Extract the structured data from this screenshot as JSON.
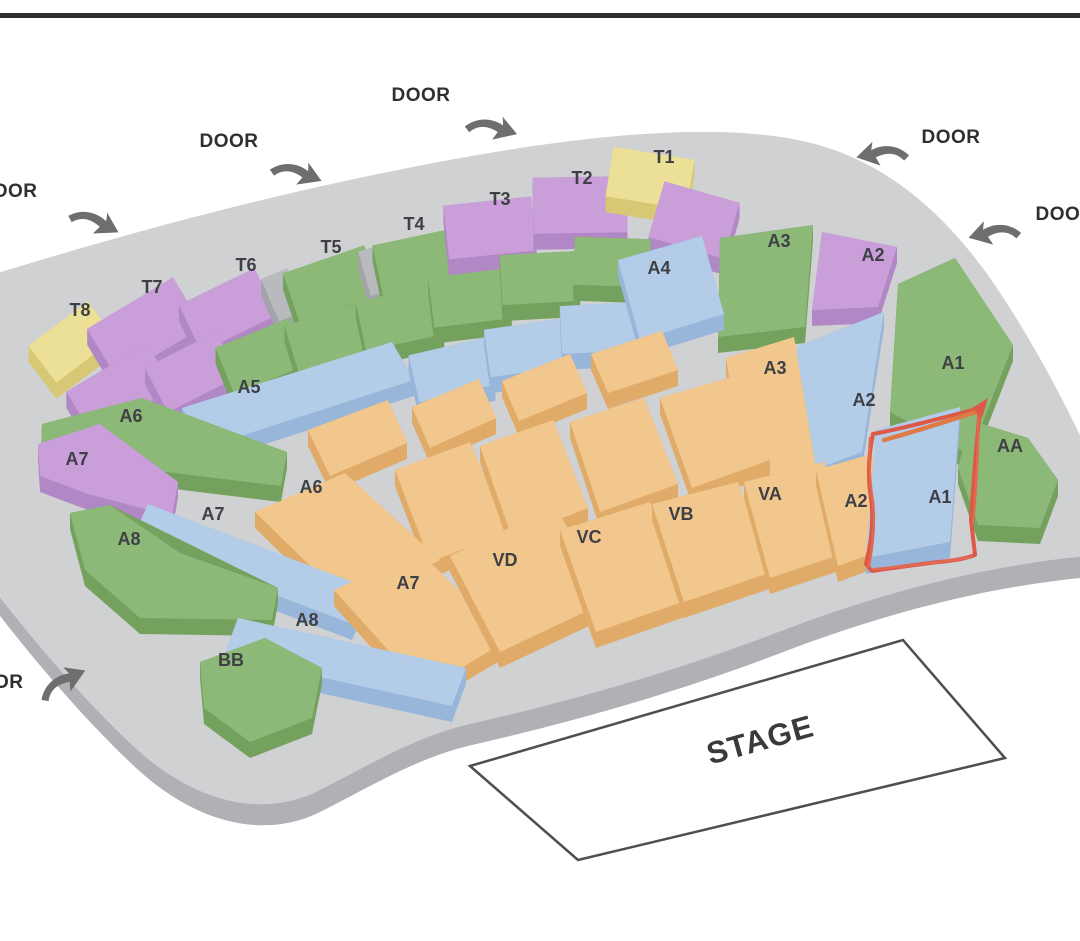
{
  "doors": {
    "label": "DOOR",
    "count": 6
  },
  "stage": {
    "label": "STAGE"
  },
  "sections": {
    "t1": {
      "label": "T1",
      "color": "yellow"
    },
    "t2": {
      "label": "T2",
      "color": "purple"
    },
    "t3": {
      "label": "T3",
      "color": "purple"
    },
    "t4": {
      "label": "T4",
      "color": "green"
    },
    "t5": {
      "label": "T5",
      "color": "green"
    },
    "t6": {
      "label": "T6",
      "color": "purple"
    },
    "t7": {
      "label": "T7",
      "color": "purple"
    },
    "t8": {
      "label": "T8",
      "color": "yellow"
    },
    "a5": {
      "label": "A5",
      "color": "blue"
    },
    "a4": {
      "label": "A4",
      "color": "blue"
    },
    "a3_top": {
      "label": "A3",
      "color": "green"
    },
    "a2_top": {
      "label": "A2",
      "color": "purple"
    },
    "a6_green": {
      "label": "A6",
      "color": "green"
    },
    "a7_purple": {
      "label": "A7",
      "color": "purple"
    },
    "a7_blue": {
      "label": "A7",
      "color": "blue"
    },
    "a8_green": {
      "label": "A8",
      "color": "green"
    },
    "a8_blue": {
      "label": "A8",
      "color": "blue"
    },
    "bb": {
      "label": "BB",
      "color": "green"
    },
    "a6_orange": {
      "label": "A6",
      "color": "orange"
    },
    "a7_orange": {
      "label": "A7",
      "color": "orange"
    },
    "vd": {
      "label": "VD",
      "color": "orange"
    },
    "vc": {
      "label": "VC",
      "color": "orange"
    },
    "vb": {
      "label": "VB",
      "color": "orange"
    },
    "va": {
      "label": "VA",
      "color": "orange"
    },
    "a3_orange": {
      "label": "A3",
      "color": "orange"
    },
    "a2_blue": {
      "label": "A2",
      "color": "blue"
    },
    "a1_green": {
      "label": "A1",
      "color": "green"
    },
    "a2_orange": {
      "label": "A2",
      "color": "orange"
    },
    "a1_blue": {
      "label": "A1",
      "color": "blue"
    },
    "aa": {
      "label": "AA",
      "color": "green"
    }
  },
  "annotation": {
    "shape": "hand-drawn rectangle",
    "color": "#dd5847",
    "marks_section": "A1"
  },
  "palette": {
    "yellow": "#ebe096",
    "purple": "#c99ed9",
    "green": "#8cb977",
    "blue": "#b3cce8",
    "orange": "#f1c78e",
    "aisle_gray": "#b9babe",
    "floor": "#d0d1d3",
    "floor_rim": "#b0b1b5",
    "red_annotation": "#dd5847",
    "stage_outline": "#4f4f4f",
    "top_border": "#2e2e2e"
  }
}
